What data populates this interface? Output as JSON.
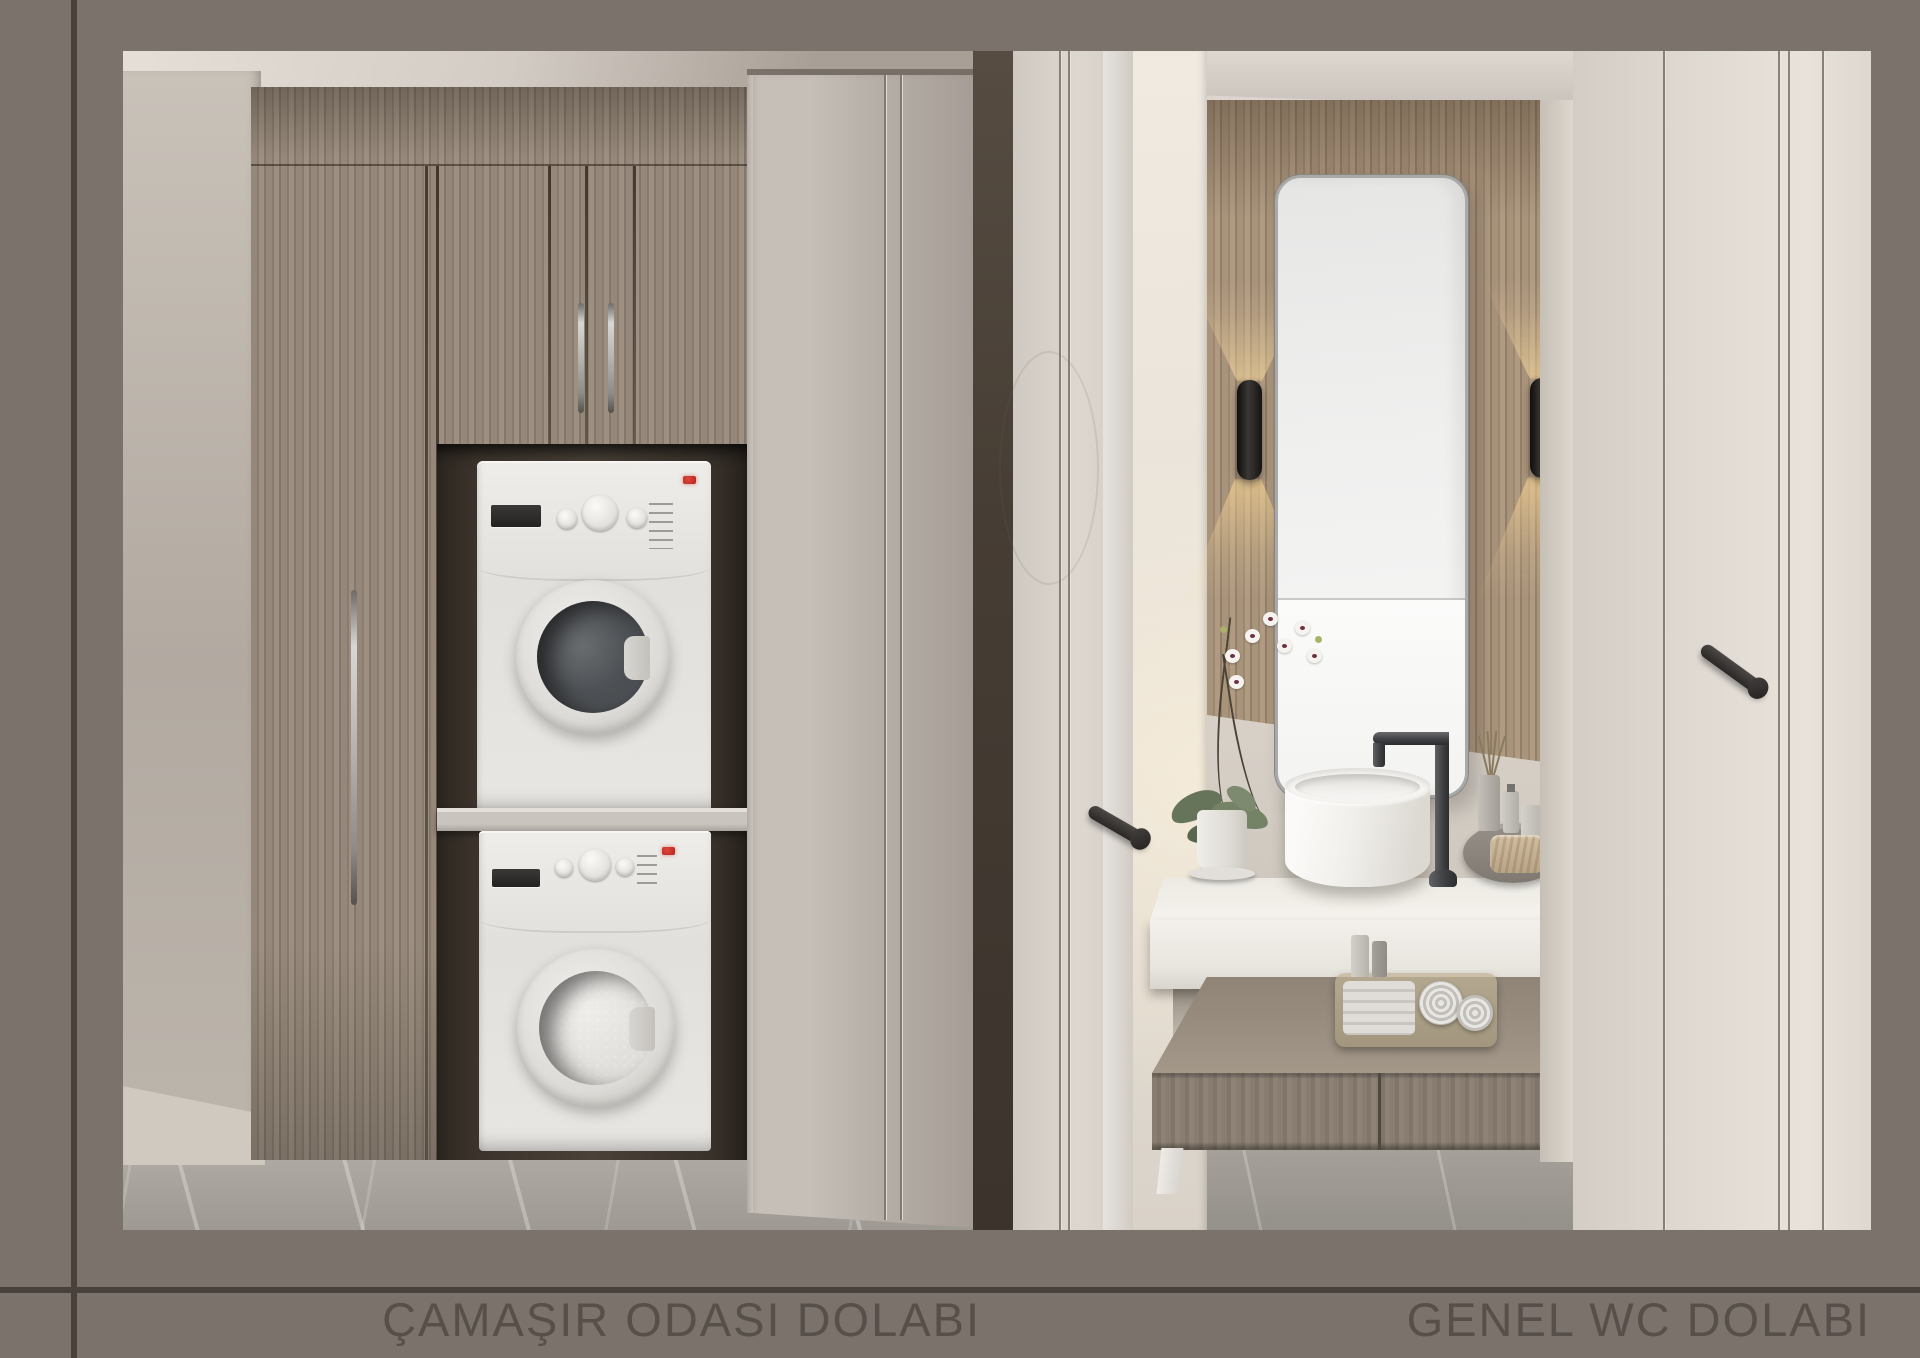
{
  "captions": {
    "laundry": "ÇAMAŞIR ODASI DOLABI",
    "wc": "GENEL WC DOLABI"
  },
  "panels": {
    "left_subject": "ÇAMAŞIR ODASI DOLABI",
    "right_subject": "GENEL WC DOLABI"
  },
  "palette": {
    "frame-bg": "#7b726b",
    "rule": "#48403a",
    "caption": "#57504a",
    "wood-light": "#9a8d7e",
    "wood-dark": "#453b31",
    "appliance": "#e9e7e3",
    "led": "#b3261e",
    "cream": "#d8d2cb",
    "glow": "#ffd9a0",
    "marble": "#a39e97"
  },
  "icons": {
    "status_led": "red-indicator-light",
    "knobs": "appliance-dial"
  }
}
